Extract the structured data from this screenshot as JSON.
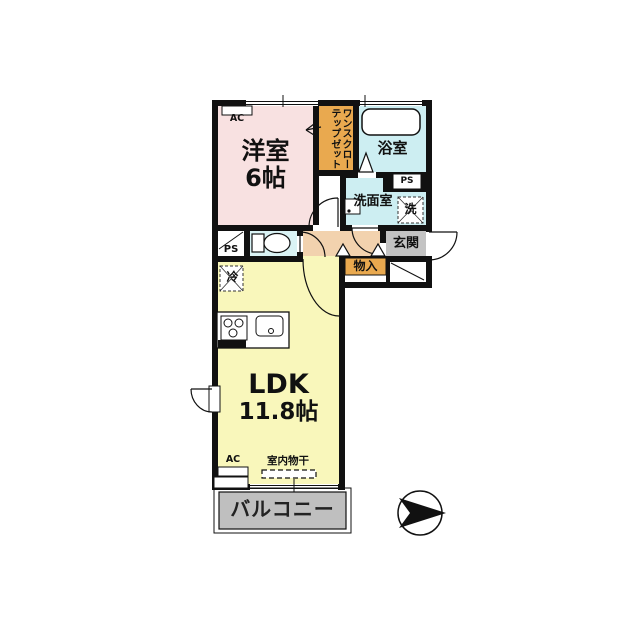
{
  "floorplan": {
    "rooms": {
      "western": {
        "name": "洋室",
        "size": "6帖"
      },
      "ldk": {
        "name": "LDK",
        "size": "11.8帖"
      },
      "bath": {
        "name": "浴室"
      },
      "washroom": {
        "name": "洗面室"
      },
      "entrance": {
        "name": "玄関"
      },
      "storage": {
        "name": "物入"
      },
      "balcony": {
        "name": "バルコニー"
      },
      "closet": {
        "line1": "ワンステップ",
        "line2": "クローゼット"
      }
    },
    "labels": {
      "ps_top": "PS",
      "ps_left": "PS",
      "ac_top": "AC",
      "ac_bottom": "AC",
      "fridge": "冷",
      "washer": "洗",
      "indoor_drying": "室内物干"
    },
    "colors": {
      "wall": "#111111",
      "western_room": "#f8e1e1",
      "closet_orange": "#e9a94f",
      "water_cyan": "#cdeef2",
      "hall_peach": "#f2d2ae",
      "ldk_yellow": "#f9f7bb",
      "entrance_gray": "#c3c3c3",
      "balcony_gray": "#bfbfbf"
    }
  }
}
